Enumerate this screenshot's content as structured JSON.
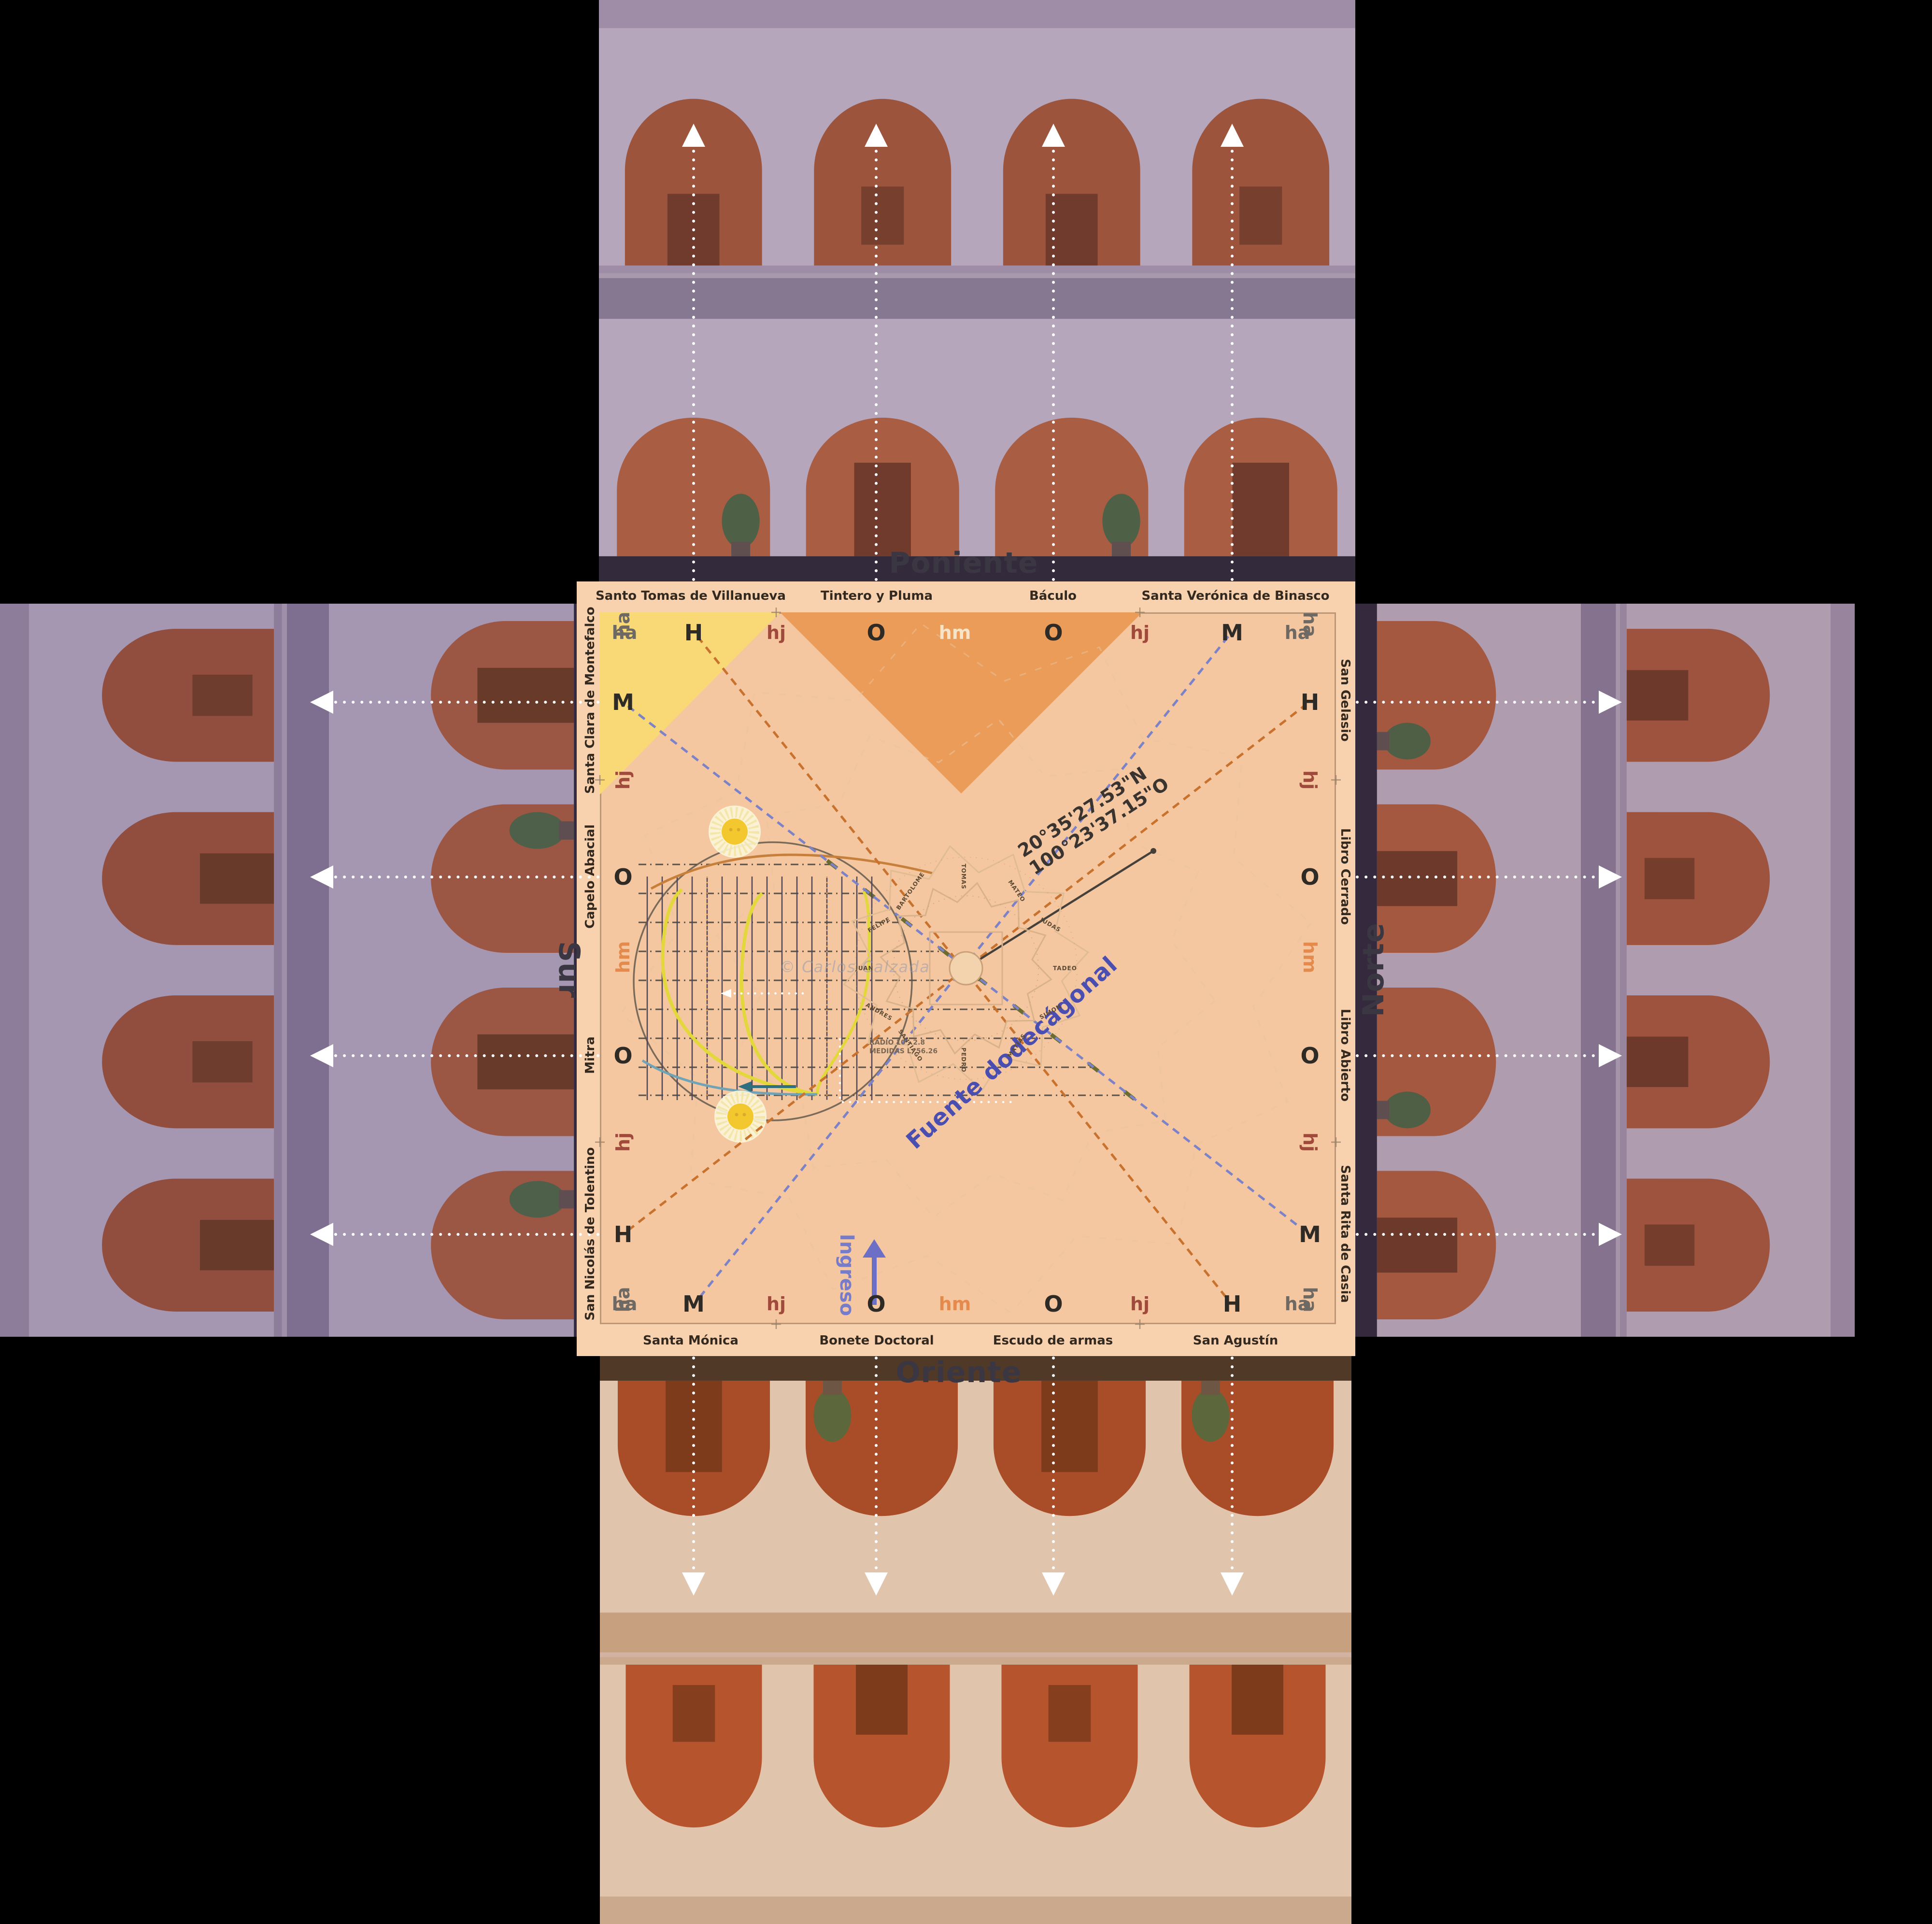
{
  "panels": {
    "poniente": {
      "title": "Poniente"
    },
    "norte": {
      "title": "Norte"
    },
    "sur": {
      "title": "Sur"
    },
    "oriente": {
      "title": "Oriente"
    }
  },
  "plan": {
    "relief_labels": {
      "top": [
        "Santo Tomas de Villanueva",
        "Tintero y Pluma",
        "Báculo",
        "Santa Verónica de Binasco"
      ],
      "bottom": [
        "Santa Mónica",
        "Bonete Doctoral",
        "Escudo de armas",
        "San Agustín"
      ],
      "left": [
        "Santa Clara de Montefalco",
        "Capelo Abacial",
        "Mitra",
        "San Nicolás de Tolentino"
      ],
      "right": [
        "San Gelasio",
        "Libro Cerrado",
        "Libro Abierto",
        "Santa Rita de Casia"
      ]
    },
    "hour_letters": {
      "top": [
        "ha",
        "H",
        "hj",
        "O",
        "hm",
        "O",
        "hj",
        "M",
        "ha"
      ],
      "bottom": [
        "ha",
        "M",
        "hj",
        "O",
        "hm",
        "O",
        "hj",
        "H",
        "ha"
      ],
      "left": [
        "ha",
        "M",
        "hj",
        "O",
        "hm",
        "O",
        "hj",
        "H",
        "ha"
      ],
      "right": [
        "ha",
        "H",
        "hj",
        "O",
        "hm",
        "O",
        "hj",
        "M",
        "ha"
      ]
    },
    "coordinates": {
      "lat": "20°35'27.53\"N",
      "lon": "100°23'37.15\"O"
    },
    "fountain_label": "Fuente dodecágonal",
    "entrance_label": "Ingreso",
    "watermark": "© Carlos Calzada",
    "fine_print": [
      "RADIO 10 - 2.8",
      "MEDIDAS L, 56.26"
    ],
    "apostles": [
      "TOMAS",
      "MATEO",
      "JUDAS",
      "TADEO",
      "SIMON",
      "MATIAS",
      "PEDRO",
      "SANTIAGO",
      "ANDRES",
      "JUAN",
      "FELIPE",
      "BARTOLOME"
    ]
  },
  "colors": {
    "background": "#000000",
    "plan_bg": "#F5C7A0",
    "morning_zone": "#F8D975",
    "noon_zone": "#EC9C59",
    "sun_line": "#C8722E",
    "moon_line": "#7B82C8",
    "fountain_text": "#4A4EB0",
    "entrance_text": "#767BCA",
    "arrow_white": "#FFFFFF"
  }
}
